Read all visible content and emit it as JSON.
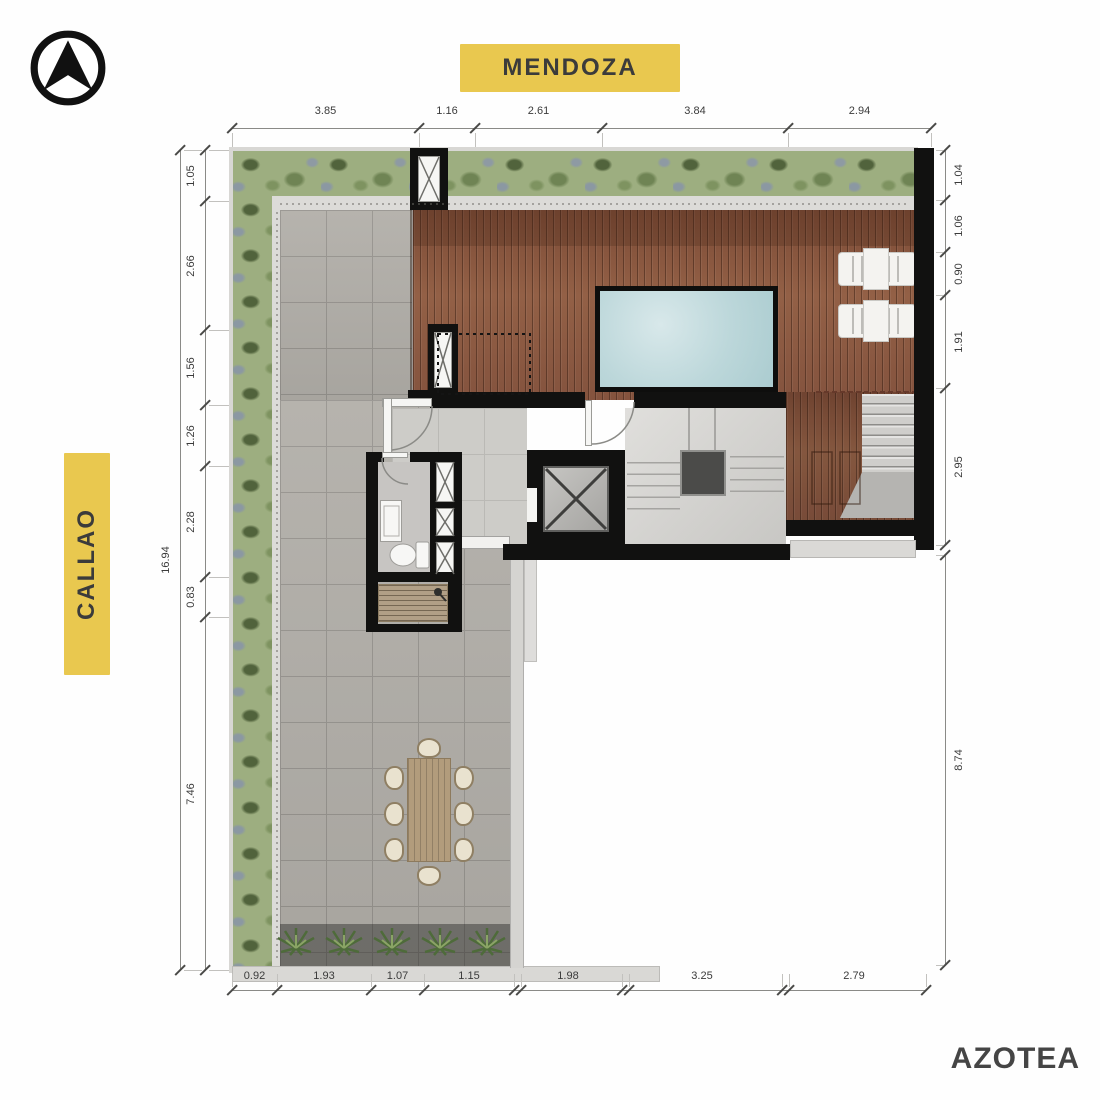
{
  "page": {
    "title_plan": "AZOTEA"
  },
  "streets": {
    "top": "MENDOZA",
    "left": "CALLAO"
  },
  "icons": {
    "north": "north-arrow-icon"
  },
  "colors": {
    "accent_yellow": "#e9c84f",
    "label_text": "#3b3b3b",
    "wall_black": "#111110",
    "wood_deck": "#8a5741",
    "pool_water": "#c2dbde",
    "hedge_green": "#9dae80",
    "tile_grey": "#b2afa9",
    "dim_text": "#3b3b3b"
  },
  "dimensions": {
    "top": [
      "3.85",
      "1.16",
      "2.61",
      "3.84",
      "2.94"
    ],
    "bottom": [
      "0.92",
      "1.93",
      "1.07",
      "1.15",
      "1.98",
      "3.25",
      "2.79"
    ],
    "left": [
      "1.05",
      "2.66",
      "1.56",
      "1.26",
      "2.28",
      "0.83",
      "7.46"
    ],
    "left_overall": [
      "16.94"
    ],
    "right": [
      "1.04",
      "1.06",
      "0.90",
      "1.91",
      "2.95"
    ],
    "right_lower": [
      "8.74"
    ]
  }
}
